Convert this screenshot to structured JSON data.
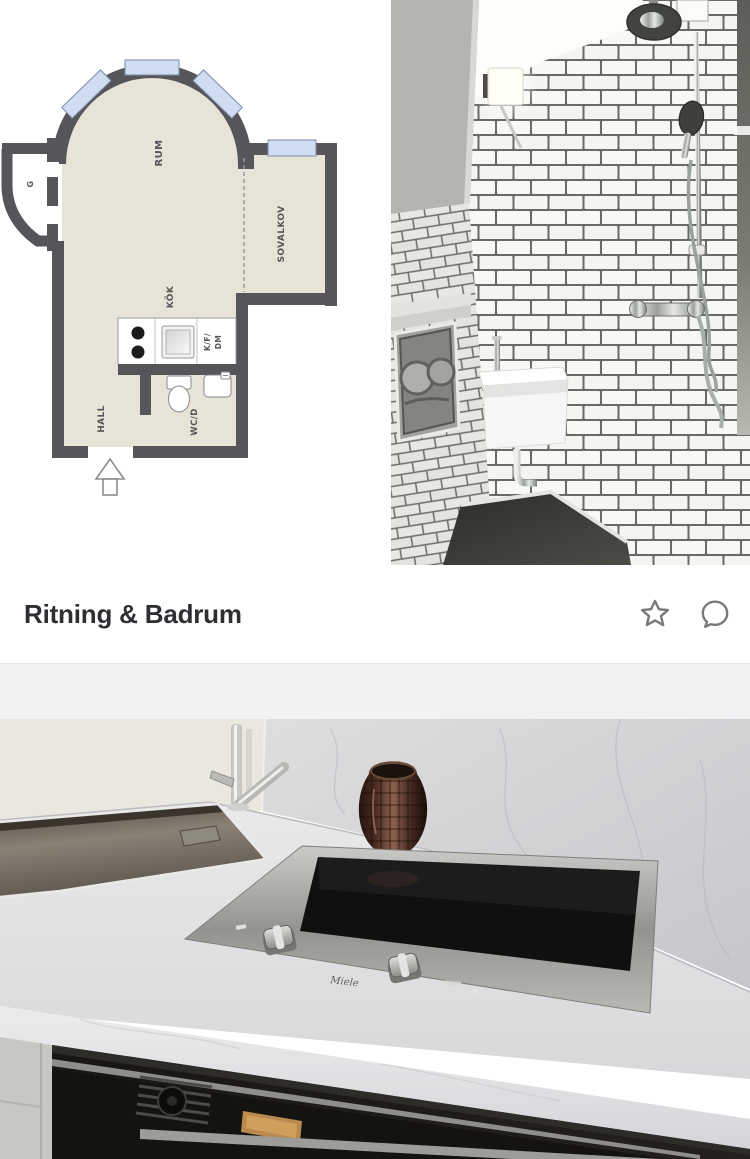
{
  "gallery": {
    "caption": "Ritning & Badrum",
    "favorite_icon": "star-outline",
    "comment_icon": "speech-bubble-outline",
    "images": [
      {
        "name": "floor-plan"
      },
      {
        "name": "bathroom-photo"
      },
      {
        "name": "kitchen-photo"
      }
    ]
  },
  "floorplan": {
    "labels": {
      "rum": "RUM",
      "sovalkov": "SOVALKOV",
      "kok": "KÖK",
      "kf": "K/F/",
      "dm": "DM",
      "wcd": "WC/D",
      "hall": "HALL",
      "closet": "G"
    }
  },
  "kitchen": {
    "cooktop_brand": "Miele"
  },
  "colors": {
    "plan_wall": "#56565a",
    "plan_floor": "#e7e3d6",
    "plan_window": "#cfdcf2",
    "divider_band": "#f1f2f4",
    "caption_text": "#2e2e33",
    "icon_gray": "#7a7a7a"
  }
}
